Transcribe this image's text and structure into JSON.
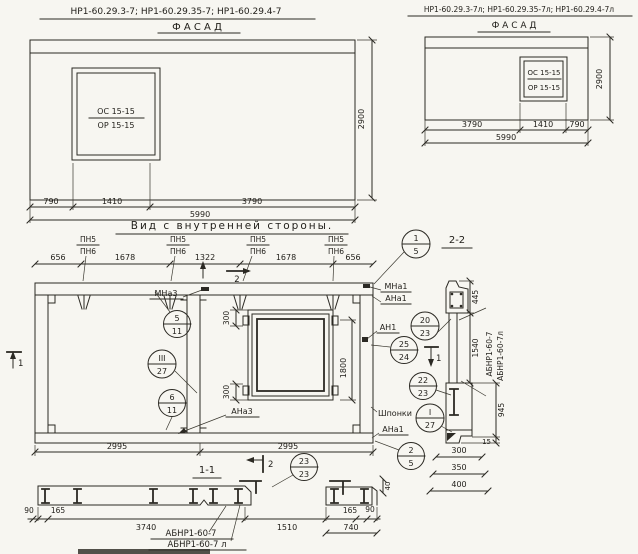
{
  "palette": {
    "paper": "#f7f6f1",
    "ink": "#2b2923"
  },
  "header_left": {
    "marks": "НР1-60.29.3-7; НР1-60.29.35-7; НР1-60.29.4-7",
    "view": "Ф А С А Д"
  },
  "header_right": {
    "marks": "НР1-60.29.3-7л; НР1-60.29.35-7л; НР1-60.29.4-7л",
    "view": "Ф А С А Д"
  },
  "facade_left": {
    "window_top": "ОС 15-15",
    "window_bot": "ОР 15-15",
    "d790": "790",
    "d1410": "1410",
    "d3790": "3790",
    "total": "5990",
    "height": "2900"
  },
  "facade_right": {
    "window_top": "ОС 15-15",
    "window_bot": "ОР 15-15",
    "d3790": "3790",
    "d1410": "1410",
    "d790": "790",
    "total": "5990",
    "height": "2900"
  },
  "inner": {
    "title": "Вид с внутренней стороны.",
    "pn_top": "ПН5",
    "pn_bot": "ПН6",
    "d656": "656",
    "d1678": "1678",
    "d1322": "1322",
    "d300": "300",
    "d1800": "1800",
    "d2995": "2995",
    "mna3": "МНа3",
    "ana3": "АНа3",
    "mna1": "МНа1",
    "ana1": "АНа1",
    "an1": "АН1",
    "shponki": "Шпонки",
    "cut1": "1",
    "cut2": "2"
  },
  "balloons": {
    "b1_5": {
      "t": "1",
      "b": "5"
    },
    "b5_11": {
      "t": "5",
      "b": "11"
    },
    "b3_27": {
      "t": "III",
      "b": "27"
    },
    "b6_11": {
      "t": "6",
      "b": "11"
    },
    "b20_23": {
      "t": "20",
      "b": "23"
    },
    "b25_24": {
      "t": "25",
      "b": "24"
    },
    "b22_23": {
      "t": "22",
      "b": "23"
    },
    "b1_27": {
      "t": "I",
      "b": "27"
    },
    "b2_5": {
      "t": "2",
      "b": "5"
    },
    "b23_23": {
      "t": "23",
      "b": "23"
    }
  },
  "sec11": {
    "title": "1-1",
    "d90": "90",
    "d165": "165",
    "d3740": "3740",
    "d1510": "1510",
    "d740": "740",
    "d40": "40",
    "mark": "АБНР1-60-7",
    "mark_l": "АБНР1-60-7 л"
  },
  "sec22": {
    "title": "2-2",
    "d445": "445",
    "d1540": "1540",
    "d945": "945",
    "d15": "15",
    "d300": "300",
    "d350": "350",
    "d400": "400",
    "mark": "АБНР1-60-7",
    "mark_l": "АБНР1-60-7л"
  }
}
